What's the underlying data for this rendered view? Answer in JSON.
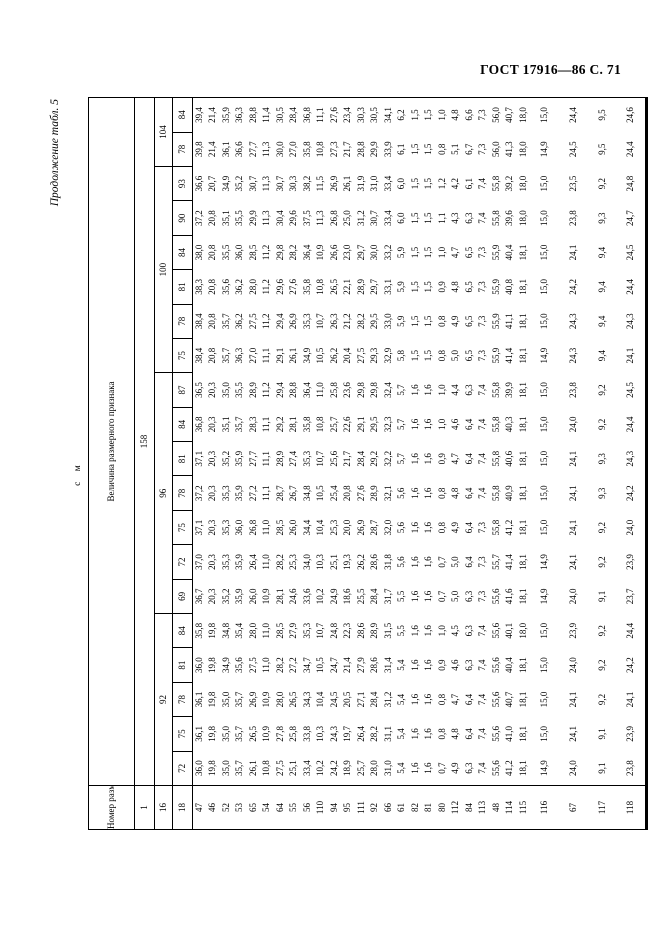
{
  "page_header": {
    "running_title": "ГОСТ 17916—86 С. 71",
    "continuation_note": "Продолжение табл. 5",
    "units_label": "с м"
  },
  "table": {
    "corner_header": "Номер размерного признака",
    "value_header": "Величина размерного признака",
    "row1_feature": "1",
    "row16_feature": "16",
    "row18_feature": "18",
    "height_value": "158",
    "chest_groups": [
      {
        "label": "92",
        "span": 5
      },
      {
        "label": "96",
        "span": 7
      },
      {
        "label": "100",
        "span": 6
      },
      {
        "label": "104",
        "span": 2
      }
    ],
    "waist_values": [
      "72",
      "75",
      "78",
      "81",
      "84",
      "69",
      "72",
      "75",
      "78",
      "81",
      "84",
      "87",
      "75",
      "78",
      "81",
      "84",
      "90",
      "93",
      "78",
      "84"
    ],
    "rows": [
      {
        "id": "47",
        "values": [
          "36,0",
          "36,1",
          "36,1",
          "36,0",
          "35,8",
          "36,7",
          "37,0",
          "37,1",
          "37,2",
          "37,1",
          "36,8",
          "36,5",
          "38,4",
          "38,4",
          "38,3",
          "38,0",
          "37,2",
          "36,6",
          "39,8",
          "39,4"
        ]
      },
      {
        "id": "46",
        "values": [
          "19,8",
          "19,8",
          "19,8",
          "19,8",
          "19,8",
          "20,3",
          "20,3",
          "20,3",
          "20,3",
          "20,3",
          "20,3",
          "20,3",
          "20,8",
          "20,8",
          "20,8",
          "20,8",
          "20,8",
          "20,7",
          "21,4",
          "21,4"
        ]
      },
      {
        "id": "52",
        "values": [
          "35,0",
          "35,0",
          "35,0",
          "34,9",
          "34,8",
          "35,2",
          "35,3",
          "35,3",
          "35,3",
          "35,2",
          "35,1",
          "35,0",
          "35,7",
          "35,7",
          "35,6",
          "35,5",
          "35,1",
          "34,9",
          "36,1",
          "35,9"
        ]
      },
      {
        "id": "53",
        "values": [
          "35,7",
          "35,7",
          "35,7",
          "35,6",
          "35,4",
          "35,9",
          "35,9",
          "36,0",
          "35,9",
          "35,9",
          "35,7",
          "35,5",
          "36,3",
          "36,2",
          "36,2",
          "36,0",
          "35,5",
          "35,2",
          "36,6",
          "36,3"
        ]
      },
      {
        "id": "65",
        "values": [
          "26,1",
          "26,5",
          "26,9",
          "27,5",
          "28,0",
          "26,0",
          "26,4",
          "26,8",
          "27,2",
          "27,7",
          "28,3",
          "28,9",
          "27,0",
          "27,5",
          "28,0",
          "28,5",
          "29,9",
          "30,7",
          "27,7",
          "28,8"
        ]
      },
      {
        "id": "54",
        "values": [
          "10,8",
          "10,9",
          "10,9",
          "11,0",
          "11,0",
          "10,9",
          "11,0",
          "11,0",
          "11,1",
          "11,1",
          "11,1",
          "11,2",
          "11,1",
          "11,2",
          "11,2",
          "11,2",
          "11,3",
          "11,3",
          "11,3",
          "11,4"
        ]
      },
      {
        "id": "64",
        "values": [
          "27,5",
          "27,8",
          "28,0",
          "28,2",
          "28,5",
          "28,1",
          "28,2",
          "28,5",
          "28,7",
          "28,9",
          "29,2",
          "29,4",
          "29,1",
          "29,4",
          "29,6",
          "29,8",
          "30,4",
          "30,7",
          "30,0",
          "30,5"
        ]
      },
      {
        "id": "55",
        "values": [
          "25,1",
          "25,8",
          "26,5",
          "27,2",
          "27,9",
          "24,6",
          "25,3",
          "26,0",
          "26,7",
          "27,4",
          "28,1",
          "28,8",
          "26,1",
          "26,9",
          "27,6",
          "28,2",
          "29,6",
          "30,3",
          "27,0",
          "28,4"
        ]
      },
      {
        "id": "56",
        "values": [
          "33,4",
          "33,8",
          "34,3",
          "34,7",
          "35,3",
          "33,6",
          "34,0",
          "34,4",
          "34,8",
          "35,3",
          "35,8",
          "36,4",
          "34,9",
          "35,3",
          "35,8",
          "36,4",
          "37,5",
          "38,2",
          "35,8",
          "36,8"
        ]
      },
      {
        "id": "110",
        "values": [
          "10,2",
          "10,3",
          "10,4",
          "10,5",
          "10,7",
          "10,2",
          "10,3",
          "10,4",
          "10,5",
          "10,7",
          "10,8",
          "11,0",
          "10,5",
          "10,7",
          "10,8",
          "10,9",
          "11,3",
          "11,5",
          "10,8",
          "11,1"
        ]
      },
      {
        "id": "94",
        "values": [
          "24,2",
          "24,3",
          "24,5",
          "24,7",
          "24,8",
          "24,9",
          "25,1",
          "25,3",
          "25,4",
          "25,6",
          "25,7",
          "25,8",
          "26,2",
          "26,3",
          "26,5",
          "26,6",
          "26,8",
          "26,9",
          "27,3",
          "27,6"
        ]
      },
      {
        "id": "95",
        "values": [
          "18,9",
          "19,7",
          "20,5",
          "21,4",
          "22,3",
          "18,6",
          "19,3",
          "20,0",
          "20,8",
          "21,7",
          "22,6",
          "23,6",
          "20,4",
          "21,2",
          "22,1",
          "23,0",
          "25,0",
          "26,1",
          "21,7",
          "23,4"
        ]
      },
      {
        "id": "111",
        "values": [
          "25,7",
          "26,4",
          "27,1",
          "27,9",
          "28,6",
          "25,5",
          "26,2",
          "26,9",
          "27,6",
          "28,4",
          "29,1",
          "29,8",
          "27,5",
          "28,2",
          "28,9",
          "29,7",
          "31,2",
          "31,9",
          "28,8",
          "30,3"
        ]
      },
      {
        "id": "92",
        "values": [
          "28,0",
          "28,2",
          "28,4",
          "28,6",
          "28,9",
          "28,4",
          "28,6",
          "28,7",
          "28,9",
          "29,2",
          "29,5",
          "29,8",
          "29,3",
          "29,5",
          "29,7",
          "30,0",
          "30,7",
          "31,0",
          "29,9",
          "30,5"
        ]
      },
      {
        "id": "66",
        "values": [
          "31,0",
          "31,1",
          "31,2",
          "31,4",
          "31,5",
          "31,7",
          "31,8",
          "32,0",
          "32,1",
          "32,2",
          "32,3",
          "32,4",
          "32,9",
          "33,0",
          "33,1",
          "33,2",
          "33,4",
          "33,4",
          "33,9",
          "34,1"
        ]
      },
      {
        "id": "61",
        "values": [
          "5,4",
          "5,4",
          "5,4",
          "5,4",
          "5,5",
          "5,5",
          "5,6",
          "5,6",
          "5,6",
          "5,7",
          "5,7",
          "5,7",
          "5,8",
          "5,9",
          "5,9",
          "5,9",
          "6,0",
          "6,0",
          "6,1",
          "6,2"
        ]
      },
      {
        "id": "82",
        "values": [
          "1,6",
          "1,6",
          "1,6",
          "1,6",
          "1,6",
          "1,6",
          "1,6",
          "1,6",
          "1,6",
          "1,6",
          "1,6",
          "1,6",
          "1,5",
          "1,5",
          "1,5",
          "1,5",
          "1,5",
          "1,5",
          "1,5",
          "1,5"
        ]
      },
      {
        "id": "81",
        "values": [
          "1,6",
          "1,6",
          "1,6",
          "1,6",
          "1,6",
          "1,6",
          "1,6",
          "1,6",
          "1,6",
          "1,6",
          "1,6",
          "1,6",
          "1,5",
          "1,5",
          "1,5",
          "1,5",
          "1,5",
          "1,5",
          "1,5",
          "1,5"
        ]
      },
      {
        "id": "80",
        "values": [
          "0,7",
          "0,8",
          "0,8",
          "0,9",
          "1,0",
          "0,7",
          "0,7",
          "0,8",
          "0,8",
          "0,9",
          "1,0",
          "1,0",
          "0,8",
          "0,8",
          "0,9",
          "1,0",
          "1,1",
          "1,2",
          "0,8",
          "1,0"
        ]
      },
      {
        "id": "112",
        "values": [
          "4,9",
          "4,8",
          "4,7",
          "4,6",
          "4,5",
          "5,0",
          "5,0",
          "4,9",
          "4,8",
          "4,7",
          "4,6",
          "4,4",
          "5,0",
          "4,9",
          "4,8",
          "4,7",
          "4,3",
          "4,2",
          "5,1",
          "4,8"
        ]
      },
      {
        "id": "84",
        "values": [
          "6,3",
          "6,4",
          "6,4",
          "6,3",
          "6,3",
          "6,3",
          "6,4",
          "6,4",
          "6,4",
          "6,4",
          "6,4",
          "6,3",
          "6,5",
          "6,5",
          "6,5",
          "6,5",
          "6,3",
          "6,1",
          "6,7",
          "6,6"
        ]
      },
      {
        "id": "113",
        "values": [
          "7,4",
          "7,4",
          "7,4",
          "7,4",
          "7,4",
          "7,3",
          "7,3",
          "7,3",
          "7,4",
          "7,4",
          "7,4",
          "7,4",
          "7,3",
          "7,3",
          "7,3",
          "7,3",
          "7,4",
          "7,4",
          "7,3",
          "7,3"
        ]
      },
      {
        "id": "48",
        "values": [
          "55,6",
          "55,6",
          "55,6",
          "55,6",
          "55,6",
          "55,6",
          "55,7",
          "55,8",
          "55,8",
          "55,8",
          "55,8",
          "55,8",
          "55,9",
          "55,9",
          "55,9",
          "55,9",
          "55,8",
          "55,8",
          "56,0",
          "56,0"
        ]
      },
      {
        "id": "114",
        "values": [
          "41,2",
          "41,0",
          "40,7",
          "40,4",
          "40,1",
          "41,6",
          "41,4",
          "41,2",
          "40,9",
          "40,6",
          "40,3",
          "39,9",
          "41,4",
          "41,1",
          "40,8",
          "40,4",
          "39,6",
          "39,2",
          "41,3",
          "40,7"
        ]
      },
      {
        "id": "115",
        "values": [
          "18,1",
          "18,1",
          "18,1",
          "18,1",
          "18,0",
          "18,1",
          "18,1",
          "18,1",
          "18,1",
          "18,1",
          "18,1",
          "18,1",
          "18,1",
          "18,1",
          "18,1",
          "18,1",
          "18,0",
          "18,0",
          "18,0",
          "18,0"
        ]
      },
      {
        "id": "116",
        "values": [
          "14,9",
          "15,0",
          "15,0",
          "15,0",
          "15,0",
          "14,9",
          "14,9",
          "15,0",
          "15,0",
          "15,0",
          "15,0",
          "15,0",
          "14,9",
          "15,0",
          "15,0",
          "15,0",
          "15,0",
          "15,0",
          "14,9",
          "15,0"
        ]
      },
      {
        "id": "67",
        "values": [
          "24,0",
          "24,1",
          "24,1",
          "24,0",
          "23,9",
          "24,0",
          "24,1",
          "24,1",
          "24,1",
          "24,1",
          "24,0",
          "23,8",
          "24,3",
          "24,3",
          "24,2",
          "24,1",
          "23,8",
          "23,5",
          "24,5",
          "24,4"
        ]
      },
      {
        "id": "117",
        "values": [
          "9,1",
          "9,1",
          "9,2",
          "9,2",
          "9,2",
          "9,1",
          "9,2",
          "9,2",
          "9,3",
          "9,3",
          "9,2",
          "9,2",
          "9,4",
          "9,4",
          "9,4",
          "9,4",
          "9,3",
          "9,2",
          "9,5",
          "9,5"
        ]
      },
      {
        "id": "118",
        "values": [
          "23,8",
          "23,9",
          "24,1",
          "24,2",
          "24,4",
          "23,7",
          "23,9",
          "24,0",
          "24,2",
          "24,3",
          "24,4",
          "24,5",
          "24,1",
          "24,3",
          "24,4",
          "24,5",
          "24,7",
          "24,8",
          "24,4",
          "24,6"
        ]
      }
    ],
    "tall_row_ids": [
      "116",
      "67",
      "117",
      "118"
    ]
  }
}
